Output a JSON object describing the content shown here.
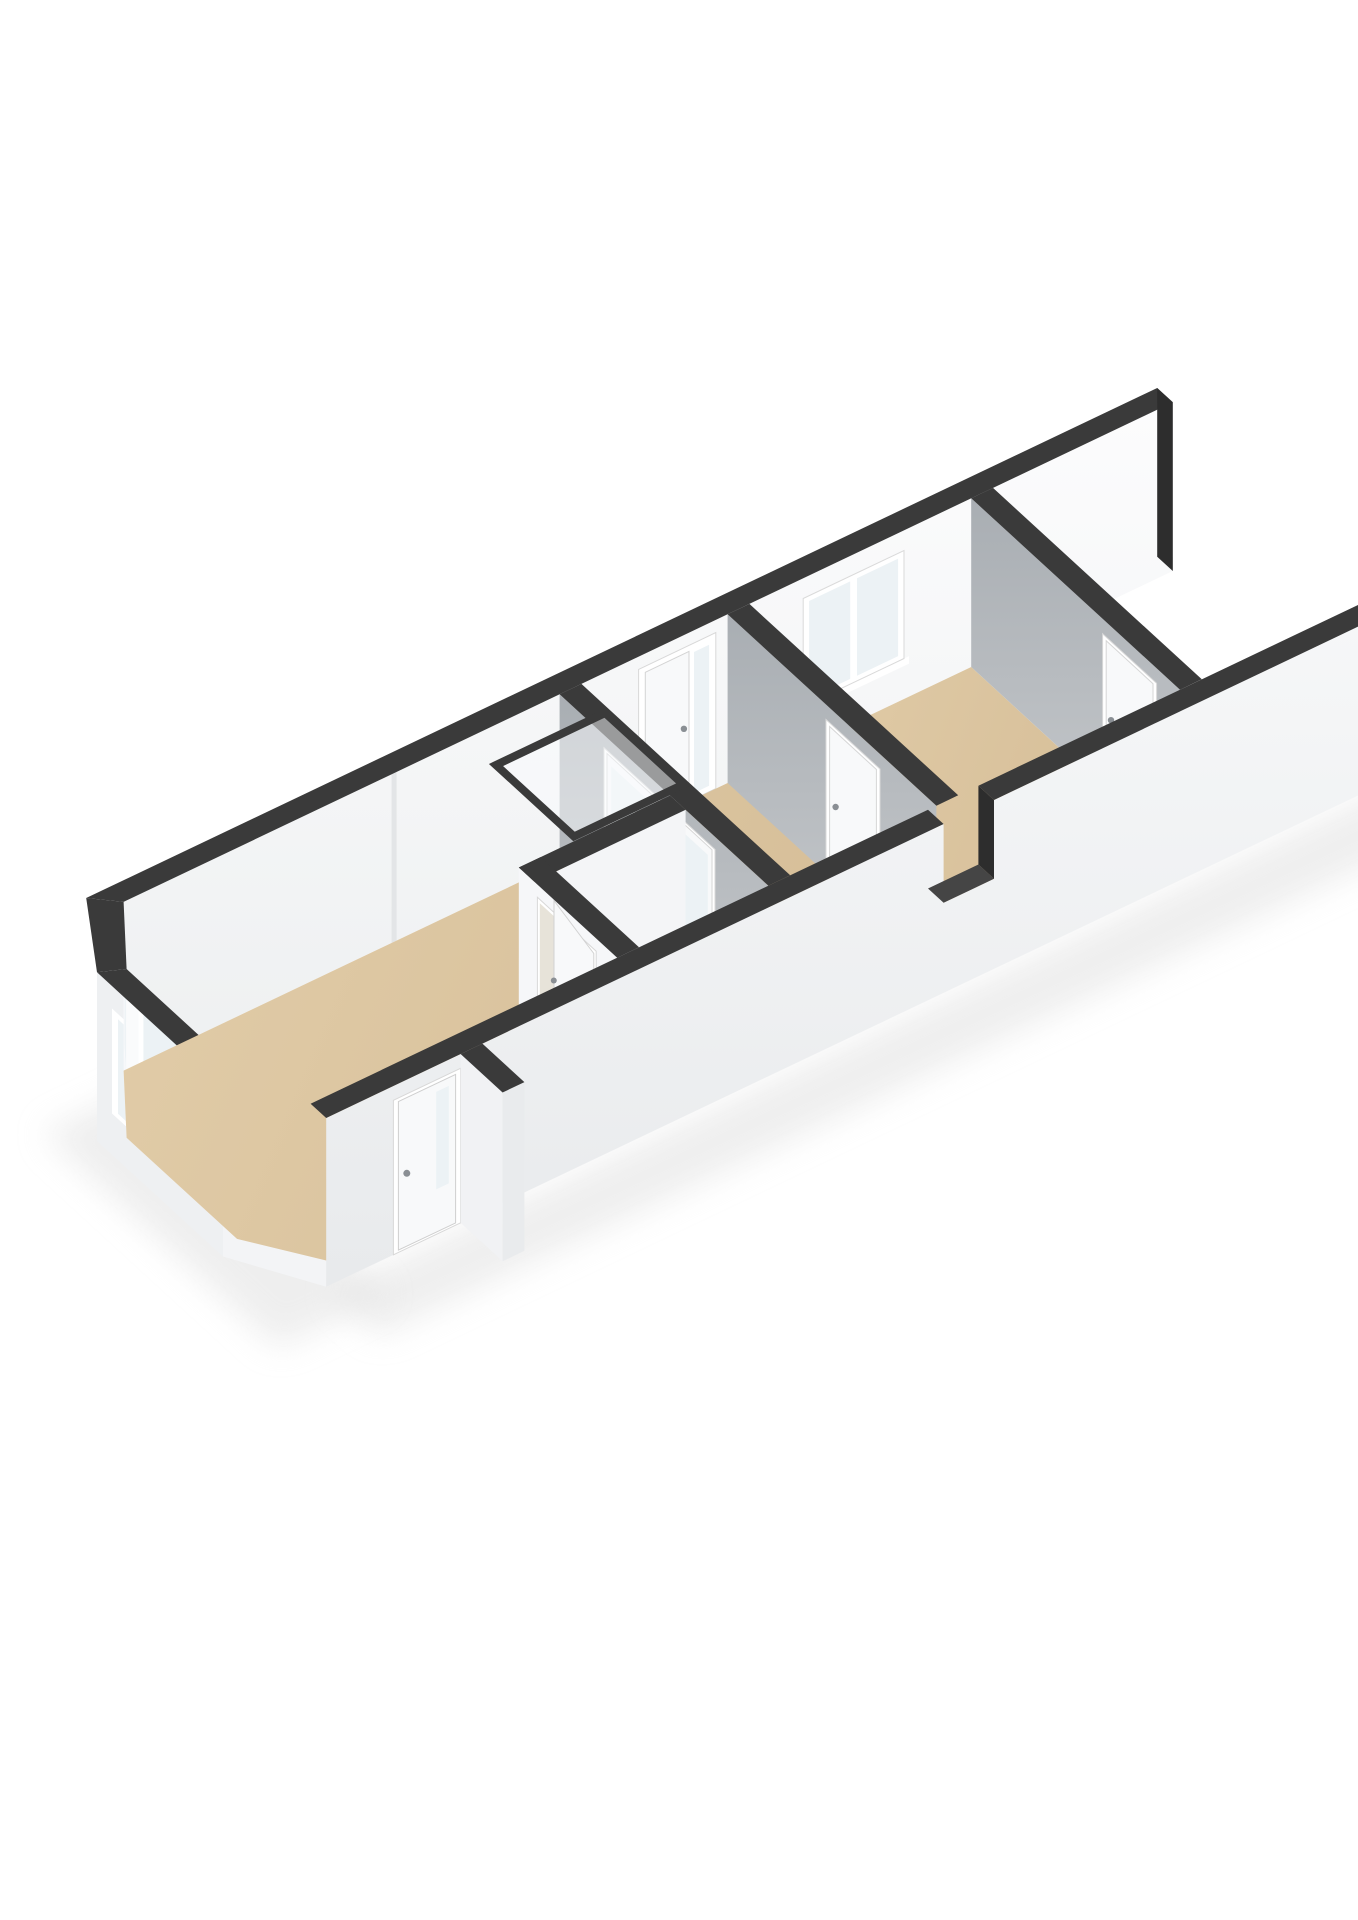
{
  "meta": {
    "title": "3D floor plan",
    "aria_label": "3D isometric floor plan rendering of a long narrow apartment with living room, storage closet, hallway and bedroom",
    "view": "isometric-3d",
    "background": "#ffffff"
  },
  "palette": {
    "background": "#ffffff",
    "wall_top_band": "#3a3a3a",
    "wall_cap_dark": "#2d2d2d",
    "notch_top": "#454545",
    "ext_wall_top": "#f8f9fa",
    "ext_wall_bottom": "#e8eaec",
    "back_wall_top": "#fcfcfd",
    "back_wall_bottom": "#eef0f1",
    "int_gray_top": "#a9aeb3",
    "int_gray_bottom": "#c6c9cc",
    "int_white_wall": "#f4f5f7",
    "bay_outer_end": "#eef0f2",
    "bay_outer_front": "#f3f4f6",
    "bay_inner_back": "#f7f8fa",
    "bay_inner_end": "#fafbfc",
    "bay_inner_front": "#f2f3f5",
    "floor_light": "#e2cda9",
    "floor_main": "#d5bd97",
    "floor_closet": "#dcb67c",
    "floor_closet_dark": "#d7ae72",
    "floor_strip_blue": "#c9d4db",
    "floor_strip_threshold": "#d2dbe1",
    "glass": "#ecf2f5",
    "frame_white": "#ffffff",
    "leaf_white": "#f8f9fa",
    "frame_stroke": "#d8d8d8",
    "handle_gray": "#8a8f94",
    "wall_seam": "#e3e5e7",
    "closet_opening": "#e7e3d9",
    "porch_face": "#f1f2f4",
    "porch_end": "#e9ebed",
    "shadow": "#dedede",
    "skylight_glass": "#fafcfd",
    "skylight_outline": "#3a3a3a"
  },
  "scene": {
    "rooms": [
      {
        "id": "living-room",
        "floor_color": "#d5bd97"
      },
      {
        "id": "storage-closet",
        "floor_color": "#dcb67c"
      },
      {
        "id": "hallway",
        "floor_color": "#d5bd97"
      },
      {
        "id": "bedroom",
        "floor_color": "#d5bd97"
      }
    ],
    "features": [
      {
        "id": "bay-window",
        "panes": 3
      },
      {
        "id": "entrance-door",
        "glass_slot": true
      },
      {
        "id": "porch-wall"
      },
      {
        "id": "skylight-window-symbol",
        "style": "dark-outlined glass panel"
      },
      {
        "id": "french-doors",
        "leaves": 2
      },
      {
        "id": "closet-door",
        "state": "ajar"
      },
      {
        "id": "hall-entry-door",
        "sidelight": true
      },
      {
        "id": "hall-door"
      },
      {
        "id": "bedroom-door"
      },
      {
        "id": "bedroom-window",
        "panes": 2
      },
      {
        "id": "front-wall-notch"
      },
      {
        "id": "open-right-segment",
        "note": "walls cut off at right edge"
      }
    ]
  }
}
